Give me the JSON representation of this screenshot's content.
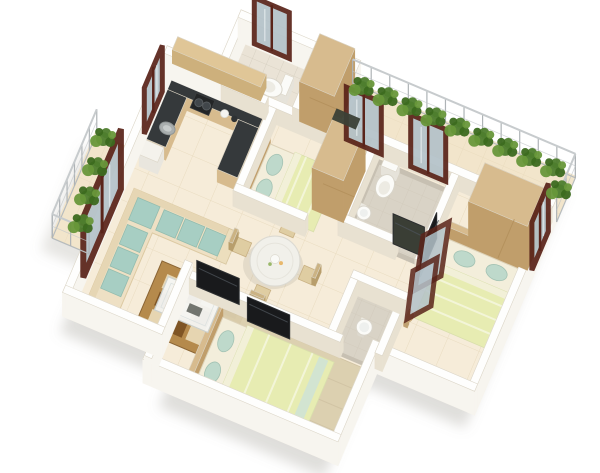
{
  "palette": {
    "wall_top": "#fefefd",
    "wall_side_outer": "#f7f5ef",
    "wall_side_inner": "#e8e1d1",
    "floor": "#f6ecd9",
    "balcony_floor": "#f2e5cb",
    "wc_floor": "#eae3d6",
    "bath_floor": "#d9d3c6",
    "bath_wall": "#c7c0b2",
    "wood": "#d7bb8e",
    "wood_dark": "#c09e6b",
    "counter": "#35393b",
    "sofa": "#eee0c4",
    "cushion": "#a7cec3",
    "bed_sheet": "#f3eedb",
    "bed_blanket": "#e7ecb2",
    "pillow": "#bed9cb",
    "rug_brown": "#b58a4c",
    "rug_dark": "#7c5223",
    "rug_cream": "#e9d9b6",
    "rug_plain": "#dbcfae",
    "table_top": "#f1f0ea",
    "chair": "#dfcda2",
    "tv": "#191a1c",
    "frame": "#5a241a",
    "glass": "#b4c2c9",
    "plant": "#4e7d2d",
    "plant_dark": "#3c6a1f",
    "plant_light": "#68973a",
    "railing": "#b6bbbd",
    "shadow": "#8d887c",
    "white_fixture": "#fbfbf8"
  },
  "scene": {
    "rotation_deg": 23,
    "plan_center": [
      210,
      165
    ],
    "screen_center": [
      300,
      238
    ],
    "canvas": [
      600,
      473
    ],
    "wall_ext_outer": 24,
    "wall_ext_inner": 16,
    "footprint": [
      [
        30,
        70
      ],
      [
        80,
        70
      ],
      [
        80,
        0
      ],
      [
        440,
        0
      ],
      [
        440,
        260
      ],
      [
        330,
        260
      ],
      [
        330,
        360
      ],
      [
        150,
        360
      ],
      [
        150,
        330
      ],
      [
        30,
        330
      ]
    ],
    "floors": [
      {
        "name": "main-floor",
        "poly": [
          [
            30,
            70
          ],
          [
            80,
            70
          ],
          [
            80,
            0
          ],
          [
            440,
            0
          ],
          [
            440,
            260
          ],
          [
            330,
            260
          ],
          [
            330,
            360
          ],
          [
            150,
            360
          ],
          [
            150,
            330
          ],
          [
            30,
            330
          ]
        ],
        "fill": "floor",
        "pattern": "tiles"
      },
      {
        "name": "balcony-floor",
        "rect": [
          196,
          0,
          244,
          52
        ],
        "fill": "balcony_floor",
        "pattern": "tiles2"
      },
      {
        "name": "west-balcony-floor",
        "rect": [
          -20,
          148,
          50,
          114
        ],
        "fill": "balcony_floor",
        "pattern": "tiles2"
      },
      {
        "name": "wc-floor",
        "rect": [
          84,
          8,
          74,
          54
        ],
        "fill": "wc_floor",
        "pattern": "tiles3"
      },
      {
        "name": "bathroom-floor",
        "rect": [
          252,
          64,
          78,
          78
        ],
        "fill": "bath_floor",
        "pattern": "tiles3",
        "stroke": "bath_wall",
        "sw": 5
      },
      {
        "name": "basin-niche-floor",
        "rect": [
          284,
          194,
          46,
          62
        ],
        "fill": "bath_floor",
        "pattern": "tiles3",
        "stroke": "bath_wall",
        "sw": 4
      }
    ],
    "rugs": [
      {
        "type": "rug_check",
        "name": "living-room-rug",
        "r": [
          92,
          240,
          96,
          72
        ]
      },
      {
        "type": "rug",
        "name": "master-bedroom-rug",
        "r": [
          164,
          260,
          158,
          92
        ]
      }
    ],
    "low": [
      {
        "type": "box",
        "name": "kitchen-counter-north",
        "r": [
          34,
          70,
          100,
          22
        ],
        "ext": 13,
        "top": "counter",
        "side": "wood"
      },
      {
        "type": "box",
        "name": "kitchen-counter-west",
        "r": [
          34,
          92,
          22,
          54
        ],
        "ext": 13,
        "top": "counter",
        "side": "wood"
      },
      {
        "type": "box",
        "name": "kitchen-counter-peninsula",
        "r": [
          112,
          92,
          22,
          54
        ],
        "ext": 13,
        "top": "counter",
        "side": "wood"
      },
      {
        "type": "stove",
        "name": "stove",
        "r": [
          58,
          72,
          20,
          16
        ]
      },
      {
        "type": "sink",
        "name": "kitchen-sink",
        "c": [
          45,
          116
        ]
      },
      {
        "type": "dish",
        "name": "counter-dishes",
        "c": [
          92,
          80
        ]
      },
      {
        "type": "box",
        "name": "oven",
        "r": [
          34,
          146,
          20,
          16
        ],
        "ext": 12,
        "top": "#f4f2ec",
        "side": "#e9e6de"
      },
      {
        "type": "toilet",
        "name": "wc-toilet",
        "c": [
          124,
          38
        ],
        "dir": "w"
      },
      {
        "type": "toilet",
        "name": "bathroom-toilet",
        "c": [
          268,
          84
        ],
        "dir": "s"
      },
      {
        "type": "basin",
        "name": "bathroom-basin",
        "c": [
          259,
          117
        ],
        "r": 7
      },
      {
        "type": "basin",
        "name": "pedestal-basin",
        "c": [
          304,
          222
        ],
        "r": 8
      },
      {
        "type": "bed",
        "name": "bed-bedroom2",
        "r": [
          146,
          90,
          72,
          62
        ],
        "head": "w"
      },
      {
        "type": "bed",
        "name": "bed-bedroom3",
        "r": [
          348,
          108,
          78,
          84
        ],
        "head": "n"
      },
      {
        "type": "bed",
        "name": "bed-master",
        "r": [
          170,
          268,
          118,
          76
        ],
        "head": "w",
        "throw": true
      },
      {
        "type": "sofa",
        "name": "living-room-sofa",
        "r": [
          38,
          184,
          114,
          132
        ],
        "t": 34
      },
      {
        "type": "coffee",
        "name": "coffee-table",
        "r": [
          104,
          252,
          58,
          36
        ]
      },
      {
        "type": "table_round",
        "name": "dining-table",
        "c": [
          196,
          196
        ],
        "r": 25
      },
      {
        "type": "chairs",
        "name": "dining-chairs",
        "c": [
          196,
          196
        ],
        "r": 25
      },
      {
        "type": "sidetable",
        "name": "bedroom3-side-table",
        "c": [
          342,
          204
        ],
        "r": 7
      }
    ],
    "walls": [
      {
        "name": "wall-outer-west",
        "r": [
          22,
          62,
          8,
          268
        ],
        "outer": true
      },
      {
        "name": "wall-kitchen-north",
        "r": [
          22,
          62,
          66,
          8
        ],
        "outer": true
      },
      {
        "name": "wall-wc-west",
        "r": [
          76,
          0,
          8,
          66
        ],
        "outer": true
      },
      {
        "name": "wall-wc-north",
        "r": [
          76,
          0,
          130,
          8
        ],
        "outer": true
      },
      {
        "name": "wall-wardrobe-east",
        "r": [
          198,
          0,
          8,
          58
        ],
        "outer": true
      },
      {
        "name": "wall-outer-east",
        "r": [
          432,
          52,
          8,
          208
        ],
        "outer": true
      },
      {
        "name": "wall-bedroom3-south",
        "r": [
          326,
          252,
          114,
          8
        ],
        "outer": true
      },
      {
        "name": "wall-master-east",
        "r": [
          326,
          252,
          8,
          108
        ],
        "outer": true
      },
      {
        "name": "wall-master-south",
        "r": [
          122,
          352,
          212,
          8
        ],
        "outer": true
      },
      {
        "name": "wall-master-west",
        "r": [
          122,
          252,
          8,
          104
        ],
        "outer": true
      },
      {
        "name": "wall-living-south",
        "r": [
          22,
          322,
          108,
          8
        ],
        "outer": true
      },
      {
        "name": "wall-balcony-south",
        "r": [
          196,
          52,
          240,
          8
        ]
      },
      {
        "name": "wall-bedroom2-north",
        "r": [
          130,
          62,
          74,
          8
        ]
      },
      {
        "name": "wall-kitchen-bedroom2",
        "r": [
          136,
          70,
          8,
          92
        ]
      },
      {
        "name": "wall-wc-south",
        "r": [
          84,
          62,
          48,
          8
        ]
      },
      {
        "name": "wall-wc-divider",
        "r": [
          158,
          8,
          8,
          54
        ]
      },
      {
        "name": "wall-bedroom2-south",
        "r": [
          136,
          154,
          78,
          8
        ]
      },
      {
        "name": "wall-bath-west",
        "r": [
          244,
          60,
          8,
          88
        ]
      },
      {
        "name": "wall-bath-south",
        "r": [
          244,
          140,
          62,
          8
        ]
      },
      {
        "name": "wall-bath-east",
        "r": [
          330,
          60,
          8,
          94
        ]
      },
      {
        "name": "wall-bedroom3-west-lower",
        "r": [
          330,
          196,
          8,
          60
        ]
      },
      {
        "name": "wall-niche-north",
        "r": [
          278,
          188,
          60,
          8
        ]
      },
      {
        "name": "wall-niche-west",
        "r": [
          278,
          196,
          8,
          60
        ]
      },
      {
        "name": "wall-master-north",
        "r": [
          130,
          252,
          164,
          8
        ]
      }
    ],
    "tall": [
      {
        "type": "box",
        "name": "wardrobe-entry",
        "r": [
          164,
          6,
          38,
          52
        ],
        "ext": 40,
        "top": "wood",
        "side": "wood_dark",
        "doors": true
      },
      {
        "type": "box",
        "name": "wardrobe-center",
        "r": [
          210,
          78,
          34,
          56
        ],
        "ext": 42,
        "top": "wood",
        "side": "wood_dark",
        "doors": true
      },
      {
        "type": "box",
        "name": "wardrobe-bedroom3",
        "r": [
          368,
          64,
          64,
          42
        ],
        "ext": 44,
        "top": "wood",
        "side": "wood_dark",
        "doors": true
      },
      {
        "type": "upper",
        "name": "kitchen-upper-cabinets",
        "r": [
          36,
          68,
          96,
          14
        ],
        "lift": 30,
        "ext": 14
      }
    ],
    "standing": [
      {
        "type": "window",
        "name": "window-living",
        "seg": [
          26,
          190,
          26,
          286
        ],
        "h": 60,
        "fw": 6
      },
      {
        "type": "window",
        "name": "window-kitchen",
        "seg": [
          26,
          84,
          26,
          130
        ],
        "h": 46,
        "fw": 5
      },
      {
        "type": "window",
        "name": "window-wc",
        "seg": [
          92,
          4,
          130,
          4
        ],
        "h": 46,
        "fw": 5
      },
      {
        "type": "window",
        "name": "window-balcony-1",
        "seg": [
          214,
          56,
          252,
          56
        ],
        "h": 52,
        "fw": 5
      },
      {
        "type": "window",
        "name": "window-balcony-2",
        "seg": [
          284,
          56,
          322,
          56
        ],
        "h": 52,
        "fw": 5
      },
      {
        "type": "window",
        "name": "window-east",
        "seg": [
          436,
          62,
          436,
          104
        ],
        "h": 48,
        "fw": 5
      },
      {
        "type": "panel",
        "name": "tv-living",
        "seg": [
          134,
          250,
          180,
          250
        ],
        "h": 26,
        "fill": "tv"
      },
      {
        "type": "panel",
        "name": "tv-master",
        "seg": [
          194,
          262,
          240,
          262
        ],
        "h": 24,
        "fill": "tv"
      },
      {
        "type": "panel",
        "name": "tv-bedroom3",
        "seg": [
          336,
          112,
          336,
          154
        ],
        "h": 26,
        "fill": "tv"
      },
      {
        "type": "panel",
        "name": "shower-panel",
        "seg": [
          298,
          134,
          332,
          134
        ],
        "h": 30,
        "fill": "#3a3e35"
      },
      {
        "type": "leaning",
        "name": "leaning-window-frames",
        "quads": [
          [
            [
              415,
              290
            ],
            [
              441,
              276
            ],
            [
              449,
              222
            ],
            [
              423,
              236
            ]
          ],
          [
            [
              407,
              319
            ],
            [
              431,
              306
            ],
            [
              437,
              258
            ],
            [
              413,
              271
            ]
          ]
        ]
      }
    ],
    "deco": [
      {
        "type": "flat",
        "name": "balcony-mat",
        "r": [
          200,
          48,
          26,
          12
        ],
        "raise": 18,
        "fill": "#3b4036"
      },
      {
        "type": "railing",
        "name": "balcony-railing-north",
        "seg": [
          198,
          2,
          440,
          2
        ]
      },
      {
        "type": "railing",
        "name": "balcony-railing-east",
        "seg": [
          440,
          2,
          440,
          50
        ]
      },
      {
        "type": "railing",
        "name": "west-balcony-railing",
        "seg": [
          -18,
          148,
          -18,
          262
        ]
      },
      {
        "type": "railing",
        "name": "west-balcony-railing-south",
        "seg": [
          -18,
          262,
          22,
          262
        ]
      },
      {
        "type": "plant",
        "name": "plant-1",
        "c": [
          212,
          12
        ]
      },
      {
        "type": "plant",
        "name": "plant-2",
        "c": [
          238,
          12
        ]
      },
      {
        "type": "plant",
        "name": "plant-3",
        "c": [
          264,
          12
        ]
      },
      {
        "type": "plant",
        "name": "plant-4",
        "c": [
          290,
          12
        ]
      },
      {
        "type": "plant",
        "name": "plant-5",
        "c": [
          316,
          12
        ]
      },
      {
        "type": "plant",
        "name": "plant-6",
        "c": [
          342,
          12
        ]
      },
      {
        "type": "plant",
        "name": "plant-7",
        "c": [
          368,
          12
        ]
      },
      {
        "type": "plant",
        "name": "plant-8",
        "c": [
          394,
          12
        ]
      },
      {
        "type": "plant",
        "name": "plant-9",
        "c": [
          420,
          12
        ]
      },
      {
        "type": "plant",
        "name": "plant-10",
        "c": [
          434,
          30
        ]
      },
      {
        "type": "plant",
        "name": "plant-11",
        "c": [
          -6,
          160
        ]
      },
      {
        "type": "plant",
        "name": "plant-12",
        "c": [
          -2,
          190
        ]
      },
      {
        "type": "plant",
        "name": "plant-13",
        "c": [
          2,
          220
        ]
      },
      {
        "type": "plant",
        "name": "plant-14",
        "c": [
          7,
          248
        ]
      }
    ]
  }
}
